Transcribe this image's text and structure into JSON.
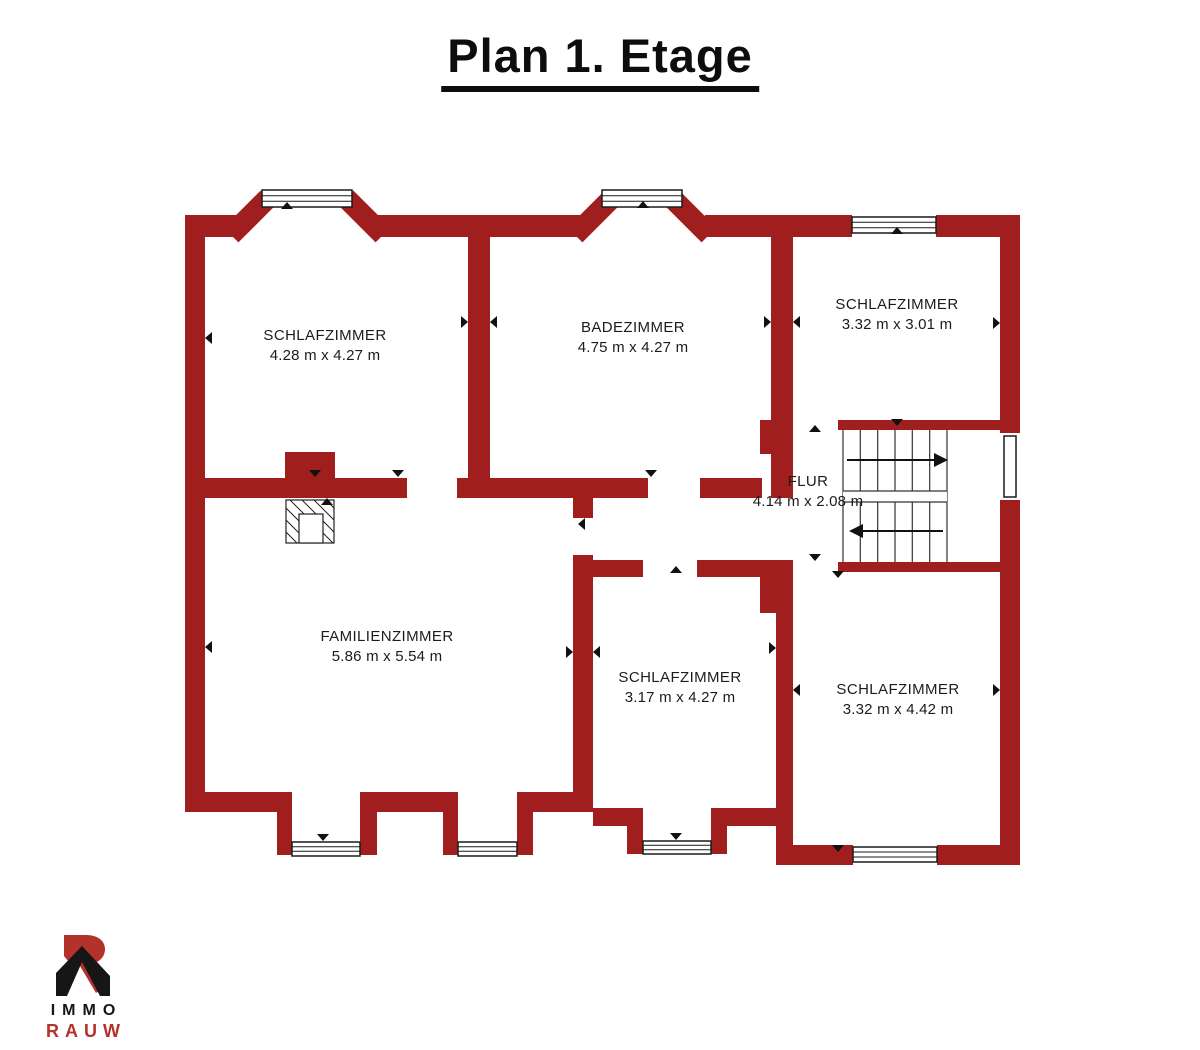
{
  "title": "Plan 1. Etage",
  "rooms": [
    {
      "id": "schlafzimmer-top-left",
      "name": "SCHLAFZIMMER",
      "dims": "4.28 m x 4.27 m"
    },
    {
      "id": "badezimmer",
      "name": "BADEZIMMER",
      "dims": "4.75 m x 4.27 m"
    },
    {
      "id": "schlafzimmer-top-right",
      "name": "SCHLAFZIMMER",
      "dims": "3.32 m x 3.01 m"
    },
    {
      "id": "flur",
      "name": "FLUR",
      "dims": "4.14 m x 2.08 m"
    },
    {
      "id": "familienzimmer",
      "name": "FAMILIENZIMMER",
      "dims": "5.86 m x 5.54 m"
    },
    {
      "id": "schlafzimmer-bottom-middle",
      "name": "SCHLAFZIMMER",
      "dims": "3.17 m x 4.27 m"
    },
    {
      "id": "schlafzimmer-bottom-right",
      "name": "SCHLAFZIMMER",
      "dims": "3.32 m x 4.42 m"
    }
  ],
  "logo": {
    "top": "IMMO",
    "bottom": "RAUW"
  },
  "colors": {
    "wall": "#A01E1E",
    "text": "#1C1C1C",
    "title": "#0D0D0D",
    "logo_black": "#161616",
    "logo_red": "#B5312C",
    "background": "#FFFFFF"
  }
}
